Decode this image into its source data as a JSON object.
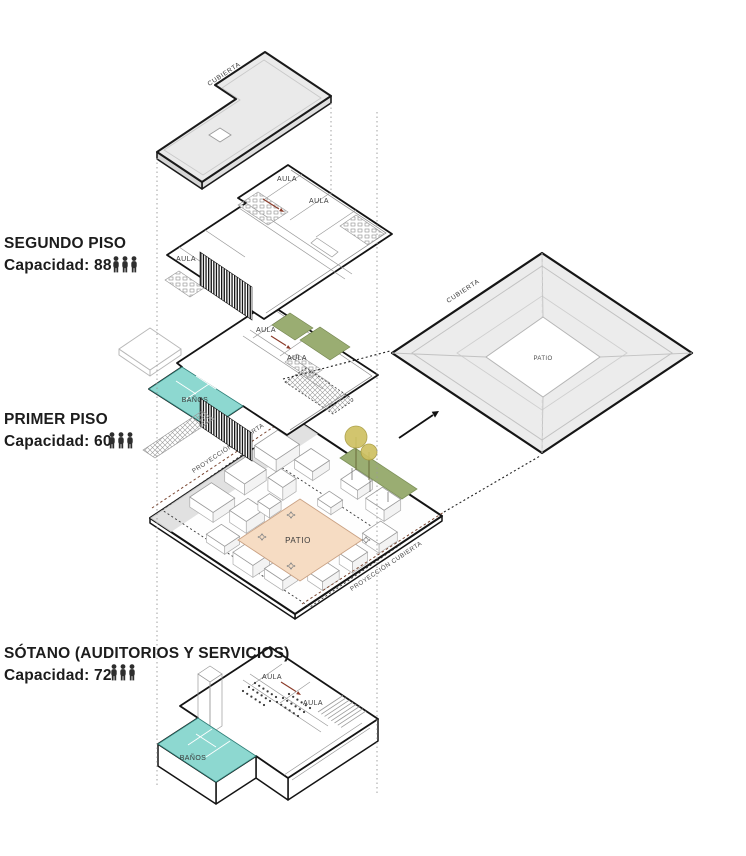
{
  "diagram": {
    "floors": [
      {
        "name": "SEGUNDO PISO",
        "capacity": "Capacidad: 88"
      },
      {
        "name": "PRIMER PISO",
        "capacity": "Capacidad: 60"
      },
      {
        "name": "SÓTANO (AUDITORIOS Y SERVICIOS)",
        "capacity": "Capacidad: 72"
      }
    ],
    "labels": {
      "aula": "AULA",
      "banos": "BAÑOS",
      "patio": "PATIO",
      "cubierta": "CUBIERTA",
      "proyeccion_cubierta": "PROYECCIÓN CUBIERTA"
    },
    "colors": {
      "banos": "#8dd8d0",
      "green": "#9aad72",
      "patio": "#f6dcc3",
      "tree": "#cfc162",
      "accent": "#8a3a28"
    }
  }
}
